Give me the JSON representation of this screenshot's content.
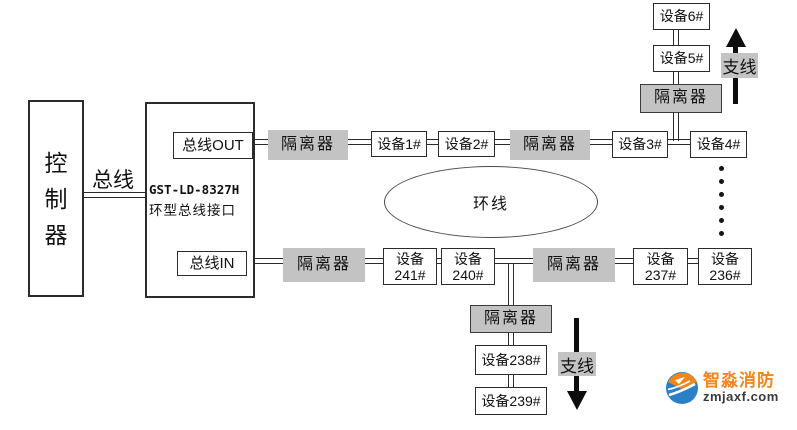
{
  "colors": {
    "gray-box": "#c3c3c3",
    "line": "#2b2b2b",
    "arrow": "#0d0d0d",
    "logo-orange": "#f0861c",
    "logo-blue": "#2b7fc4",
    "logo-domain": "#3a3a3a"
  },
  "labels": {
    "controller": "控制器",
    "bus": "总线",
    "bus_out": "总线OUT",
    "bus_in": "总线IN",
    "model": "GST-LD-8327H",
    "interface_name": "环型总线接口",
    "ring": "环线",
    "isolator": "隔离器",
    "branch": "支线"
  },
  "devices": {
    "top_row": [
      "设备1#",
      "设备2#",
      "设备3#",
      "设备4#"
    ],
    "top_branch": [
      "设备5#",
      "设备6#"
    ],
    "bottom_row": [
      {
        "l1": "设备",
        "l2": "241#"
      },
      {
        "l1": "设备",
        "l2": "240#"
      },
      {
        "l1": "设备",
        "l2": "237#"
      },
      {
        "l1": "设备",
        "l2": "236#"
      }
    ],
    "bottom_branch": [
      "设备238#",
      "设备239#"
    ]
  },
  "logo": {
    "name": "智淼消防",
    "domain": "zmjaxf.com"
  }
}
